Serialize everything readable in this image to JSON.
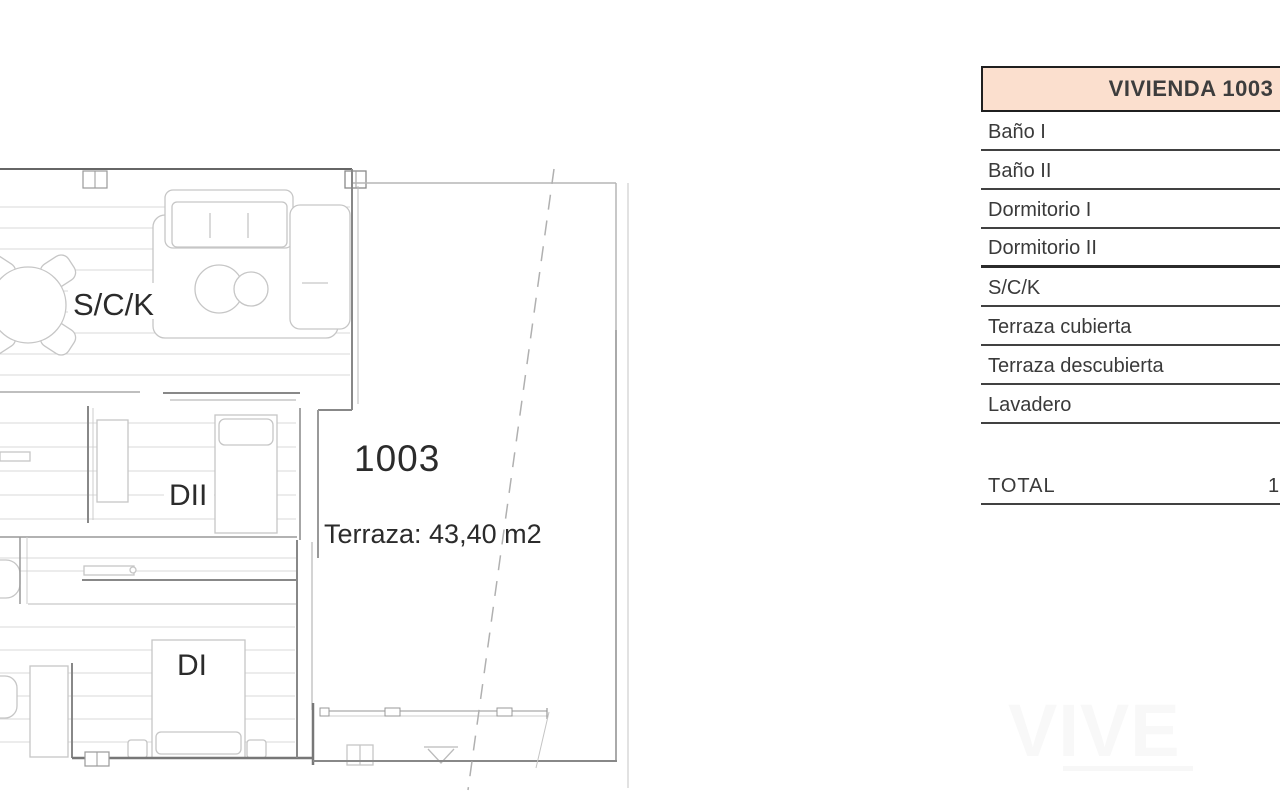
{
  "plan": {
    "room_labels": {
      "living": "S/C/K",
      "bedroom2": "DII",
      "bedroom1": "DI"
    },
    "unit_number": "1003",
    "unit_number_color": "#c5393c",
    "terrace_note": "Terraza: 43,40 m2"
  },
  "table": {
    "header": "VIVIENDA 1003",
    "header_bg": "#fbdfce",
    "rows": [
      {
        "label": "Baño I"
      },
      {
        "label": "Baño II"
      },
      {
        "label": "Dormitorio I"
      },
      {
        "label": "Dormitorio II",
        "thick_divider": true
      },
      {
        "label": "S/C/K"
      },
      {
        "label": "Terraza cubierta"
      },
      {
        "label": "Terraza descubierta"
      },
      {
        "label": "Lavadero"
      }
    ],
    "total_label": "TOTAL",
    "total_value_visible": "1"
  },
  "watermark": {
    "text": "VIVE"
  }
}
